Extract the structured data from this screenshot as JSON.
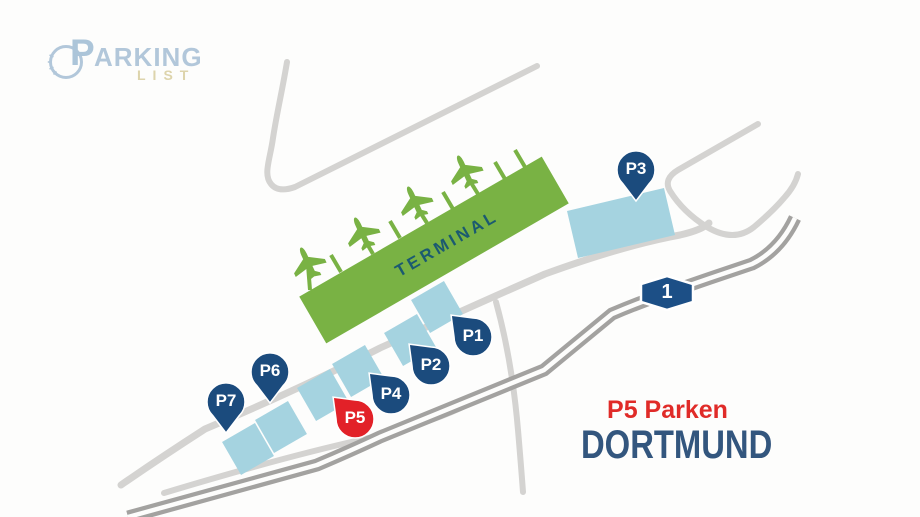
{
  "logo": {
    "p": "P",
    "word": "ARKING",
    "sub": "LIST"
  },
  "map": {
    "terminal_label": "TERMINAL",
    "route_badge": {
      "label": "1"
    },
    "pins": [
      {
        "id": "p1",
        "label": "P1",
        "x": 473,
        "y": 337,
        "style": "tilted",
        "highlight": false
      },
      {
        "id": "p2",
        "label": "P2",
        "x": 431,
        "y": 366,
        "style": "tilted",
        "highlight": false
      },
      {
        "id": "p3",
        "label": "P3",
        "x": 636,
        "y": 170,
        "style": "straight",
        "highlight": false
      },
      {
        "id": "p4",
        "label": "P4",
        "x": 391,
        "y": 395,
        "style": "tilted",
        "highlight": false
      },
      {
        "id": "p5",
        "label": "P5",
        "x": 355,
        "y": 419,
        "style": "tilted",
        "highlight": true
      },
      {
        "id": "p6",
        "label": "P6",
        "x": 270,
        "y": 372,
        "style": "straight",
        "highlight": false
      },
      {
        "id": "p7",
        "label": "P7",
        "x": 226,
        "y": 402,
        "style": "straight",
        "highlight": false
      }
    ]
  },
  "caption": {
    "line1": "P5 Parken",
    "line2": "DORTMUND"
  },
  "colors": {
    "background": "#fdfdfc",
    "terminal_green": "#79b244",
    "parking_lot_blue": "#a5d3e0",
    "pin_navy": "#1b4b7d",
    "highlight_red": "#e22128",
    "road_light": "#d4d3d1",
    "road_dark": "#a3a2a0",
    "terminal_text": "#1b5a70",
    "caption_red": "#e02b28",
    "caption_navy": "#33567e",
    "logo_blue": "#96b6d0",
    "logo_tan": "#d5c996",
    "route_badge_blue": "#1c4f86"
  }
}
